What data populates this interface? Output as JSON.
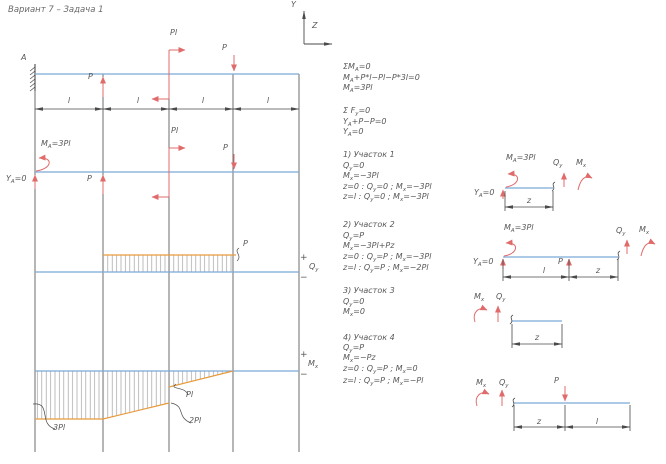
{
  "title": "Вариант 7 – Задача 1",
  "axes": {
    "y": "Y",
    "z": "Z"
  },
  "sym": {
    "plus": "+",
    "minus": "−"
  },
  "beam": {
    "support": "A",
    "load_p": "P",
    "load_m": "Pl",
    "dim": "l",
    "r_moment": "M_{A}=3Pl",
    "r_force": "Y_{A}=0"
  },
  "equations": {
    "lines": [
      "ΣM_{A}=0",
      "M_{A}+P*l−Pl−P*3l=0",
      "M_{A}=3Pl",
      "Σ F_{y}=0",
      "Y_{A}+P−P=0",
      "Y_{A}=0"
    ]
  },
  "sections": [
    {
      "lines": [
        "1) Участок 1",
        "Q_{y}=0",
        "M_{x}=−3Pl",
        "z=0 : Q_{y}=0 ; M_{x}=−3Pl",
        "z=l : Q_{y}=0 ; M_{x}=−3Pl"
      ]
    },
    {
      "lines": [
        "2) Участок 2",
        "Q_{y}=P",
        "M_{x}=−3Pl+Pz",
        "z=0 : Q_{y}=P ; M_{x}=−3Pl",
        "z=l : Q_{y}=P ; M_{x}=−2Pl"
      ]
    },
    {
      "lines": [
        "3) Участок 3",
        "Q_{y}=0",
        "M_{x}=0"
      ]
    },
    {
      "lines": [
        "4) Участок 4",
        "Q_{y}=P",
        "M_{x}=−Pz",
        "z=0 : Q_{y}=P ; M_{x}=0",
        "z=l : Q_{y}=P ; M_{x}=−Pl"
      ]
    }
  ],
  "shear": {
    "axis": "Q_{y}",
    "peak": "P"
  },
  "moment": {
    "axis": "M_{x}",
    "m3": "3Pl",
    "m1": "Pl",
    "m2": "2Pl"
  },
  "fbd1": {
    "ma": "M_{A}=3Pl",
    "ya": "Y_{A}=0",
    "qy": "Q_{y}",
    "mx": "M_{x}",
    "z": "z"
  },
  "fbd2": {
    "ma": "M_{A}=3Pl",
    "ya": "Y_{A}=0",
    "p": "P",
    "qy": "Q_{y}",
    "mx": "M_{x}",
    "l": "l",
    "z": "z"
  },
  "fbd3": {
    "qy": "Q_{y}",
    "mx": "M_{x}",
    "z": "z"
  },
  "fbd4": {
    "qy": "Q_{y}",
    "mx": "M_{x}",
    "p": "P",
    "z": "z",
    "l": "l"
  },
  "chart_data": [
    {
      "type": "line",
      "title": "Q_y diagram",
      "x_units": "l",
      "y_units": "P",
      "x": [
        0,
        1,
        1,
        3,
        3,
        4
      ],
      "y": [
        0,
        0,
        1,
        1,
        0,
        0
      ]
    },
    {
      "type": "line",
      "title": "M_x diagram",
      "x_units": "l",
      "y_units": "Pl",
      "x": [
        0,
        1,
        2,
        2,
        3,
        4
      ],
      "y": [
        -3,
        -3,
        -2,
        -1,
        0,
        0
      ]
    }
  ],
  "colors": {
    "beam": "#7ba9d6",
    "diagram_outline": "#e79a3c",
    "arrows": "#e06b6b",
    "lines": "#4a4a4a",
    "text": "#585858"
  }
}
